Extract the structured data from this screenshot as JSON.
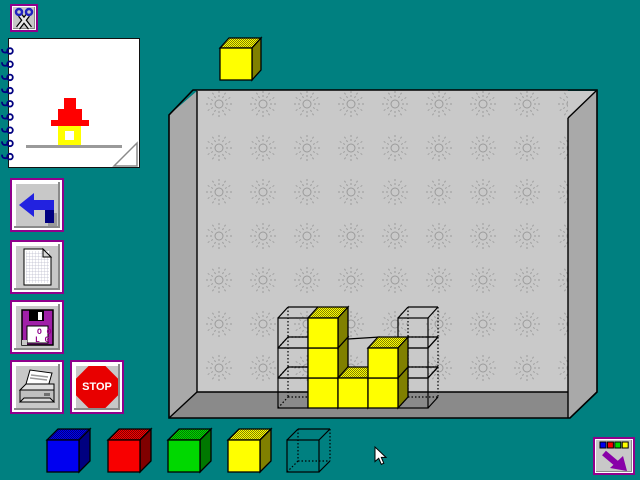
{
  "app": {
    "name": "block-building-workspace"
  },
  "colors": {
    "background": "#008080",
    "wall": "#C9C9C9",
    "wall_pattern": "#9A9A9A",
    "side_wall": "#A9A9A9",
    "floor": "#8A8A8A",
    "outline": "#000000",
    "button_face": "#C8C8C8",
    "button_border": "#90008C",
    "stop_red": "#E80000",
    "arrow_blue": "#2222E0",
    "arrow_navy": "#000080",
    "nav_arrow_purple": "#8800A8"
  },
  "cube_colors": {
    "blue": {
      "front": "#0000F0",
      "side": "#000080"
    },
    "red": {
      "front": "#F80000",
      "side": "#800000"
    },
    "green": {
      "front": "#00D800",
      "side": "#007800"
    },
    "yellow": {
      "front": "#FFFF00",
      "side": "#808000"
    }
  },
  "toolbar": {
    "cut_icon": "scissors-icon",
    "undo_icon": "undo-arrow-icon",
    "new_icon": "blank-page-icon",
    "save_icon": "floppy-disk-icon",
    "save_label_line1": "O O",
    "save_label_line2": "L G",
    "print_icon": "printer-icon",
    "stop_label": "STOP"
  },
  "notepad": {
    "rings": 9,
    "house": {
      "roof_color": "#FF0000",
      "body_color": "#FFFF00",
      "window_color": "#FFFFFF",
      "ground_color": "#9A9A9A"
    }
  },
  "floating_cube": {
    "color": "yellow",
    "x": 220,
    "y": 48,
    "size": 32,
    "dx": 9,
    "dy": 10
  },
  "room": {
    "grid": {
      "origin_x": 278,
      "bottom_y": 408,
      "cell": 30,
      "dx": 10,
      "dy": 11,
      "cols": 5,
      "levels": 3
    },
    "wire_cells": [
      [
        0,
        0
      ],
      [
        0,
        1
      ],
      [
        0,
        2
      ],
      [
        4,
        0
      ],
      [
        4,
        1
      ],
      [
        4,
        2
      ]
    ],
    "cubes": [
      {
        "col": 1,
        "level": 0,
        "color": "yellow"
      },
      {
        "col": 1,
        "level": 1,
        "color": "yellow"
      },
      {
        "col": 1,
        "level": 2,
        "color": "yellow"
      },
      {
        "col": 2,
        "level": 0,
        "color": "yellow"
      },
      {
        "col": 3,
        "level": 0,
        "color": "yellow"
      },
      {
        "col": 3,
        "level": 1,
        "color": "yellow"
      }
    ],
    "extra_lines": [
      {
        "x1": 348,
        "y1": 339,
        "x2": 380,
        "y2": 337
      }
    ]
  },
  "palette": {
    "y": 440,
    "size": 32,
    "dx": 11,
    "dy": 11,
    "items": [
      {
        "name": "block-blue",
        "color": "blue",
        "x": 47
      },
      {
        "name": "block-red",
        "color": "red",
        "x": 108
      },
      {
        "name": "block-green",
        "color": "green",
        "x": 168
      },
      {
        "name": "block-yellow",
        "color": "yellow",
        "x": 228
      },
      {
        "name": "block-wireframe",
        "color": "wire",
        "x": 287
      }
    ]
  },
  "nav_button": {
    "squares": [
      "#0000F0",
      "#F80000",
      "#00D800",
      "#FFFF00"
    ],
    "arrow": "arrow-down-right-icon"
  },
  "cursor": {
    "x": 375,
    "y": 447
  }
}
